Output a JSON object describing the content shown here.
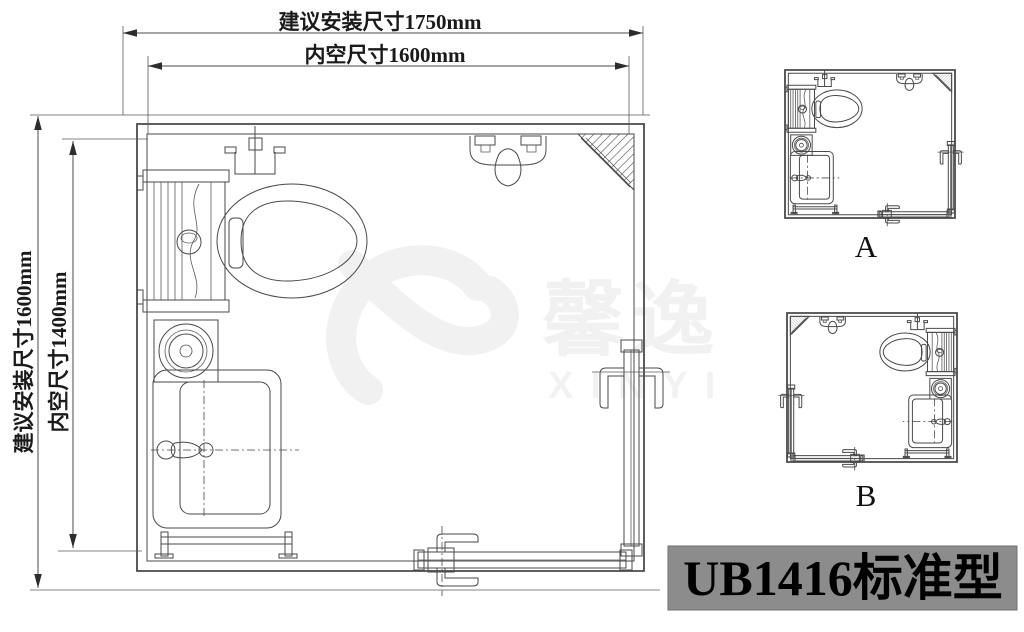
{
  "page": {
    "background": "#ffffff"
  },
  "colors": {
    "line": "#4a4a4a",
    "title_bg": "#8c8c8c",
    "title_text": "#000000",
    "watermark": "#f1f1f1",
    "dim_text": "#1a1a1a"
  },
  "dimensions": {
    "top_outer_label": "建议安装尺寸1750mm",
    "top_inner_label": "内空尺寸1600mm",
    "left_outer_label": "建议安装尺寸1600mm",
    "left_inner_label": "内空尺寸1400mm"
  },
  "plans": {
    "main": {
      "name": "main-floor-plan",
      "fixtures": [
        "paper-holder",
        "cistern",
        "toilet",
        "exhaust-fan",
        "vanity-sink",
        "faucet",
        "towel-bar",
        "shower-mixer",
        "corner-shelf",
        "sliding-door-right",
        "sliding-door-bottom"
      ]
    },
    "variant_a": {
      "label": "A"
    },
    "variant_b": {
      "label": "B"
    }
  },
  "watermark": {
    "brand_cn": "馨逸",
    "brand_en": "XINYI"
  },
  "title_block": {
    "model": "UB1416标准型"
  }
}
